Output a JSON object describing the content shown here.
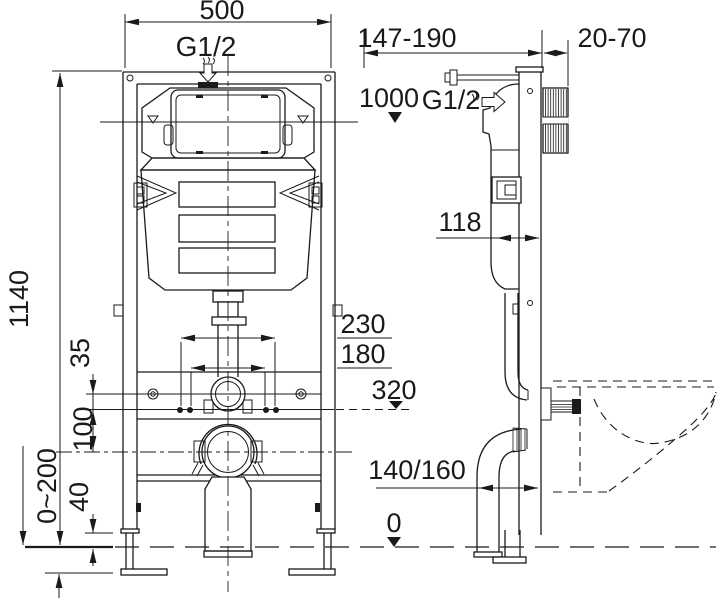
{
  "labels": {
    "overall_width": "500",
    "inlet_thread": "G1/2",
    "overall_height": "1140",
    "hole_offset": "35",
    "bend_drop": "100",
    "leg_adjustment": "0~200",
    "foot_height": "40",
    "stud_spacing_outer": "230",
    "stud_spacing_inner": "180",
    "stud_height": "320",
    "wall_distance": "147-190",
    "wall_thickness": "20-70",
    "supply_height": "1000",
    "side_inlet_thread": "G1/2",
    "frame_depth": "118",
    "drain_offset": "140/160",
    "floor_level": "0"
  },
  "icons": {
    "level_marker": "filled-triangle-down",
    "flow_arrow": "hollow-arrow-with-squiggle"
  },
  "colors": {
    "line": "#1a1a1a",
    "background": "#ffffff"
  }
}
